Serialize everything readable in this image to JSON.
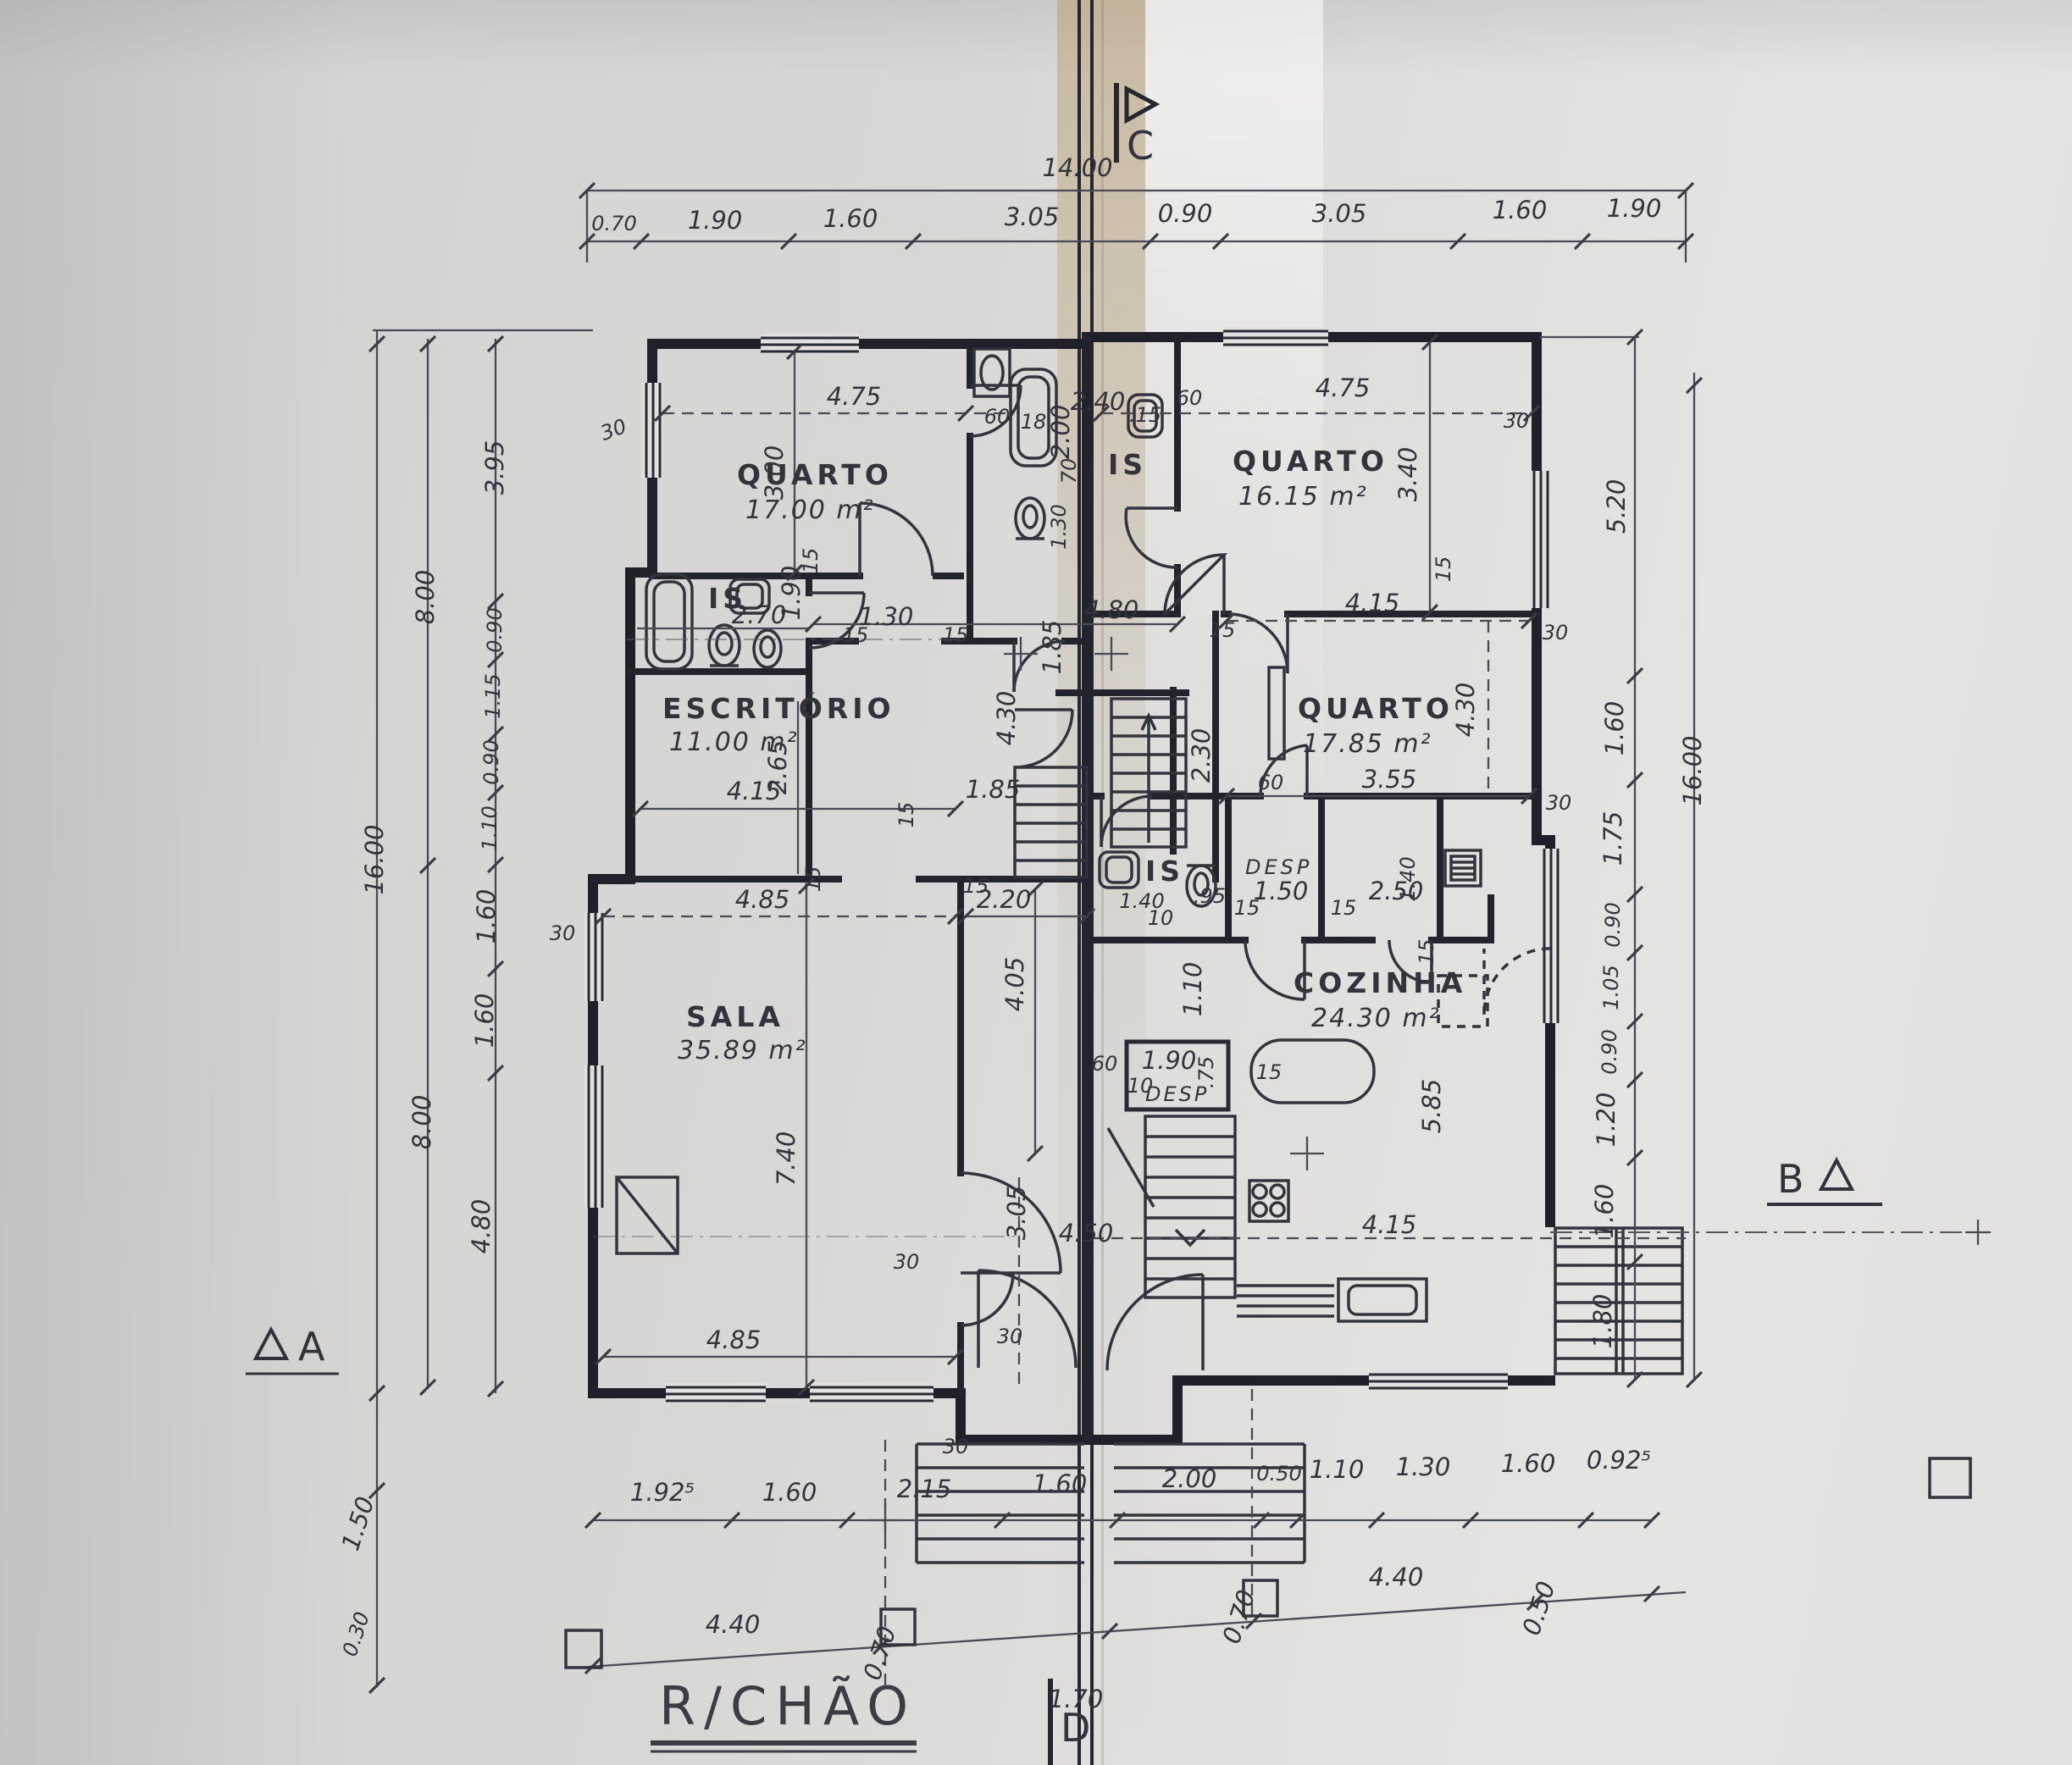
{
  "title": "R/CHÃO",
  "markers": {
    "c": "C",
    "d": "D",
    "a": "A",
    "b": "B"
  },
  "rooms": {
    "quarto1": {
      "name": "QUARTO",
      "area": "17.00 m²"
    },
    "quarto2": {
      "name": "QUARTO",
      "area": "16.15 m²"
    },
    "quarto3": {
      "name": "QUARTO",
      "area": "17.85 m²"
    },
    "escritorio": {
      "name": "ESCRITÓRIO",
      "area": "11.00 m²"
    },
    "sala": {
      "name": "SALA",
      "area": "35.89 m²"
    },
    "cozinha": {
      "name": "COZINHA",
      "area": "24.30 m²"
    },
    "is": "IS",
    "desp": "DESP"
  },
  "dims": {
    "overall_top": "14.00",
    "top": [
      "0.70",
      "1.90",
      "1.60",
      "3.05",
      "0.90",
      "3.05",
      "1.60",
      "1.90"
    ],
    "left": {
      "outer": "16.00",
      "mid_a": "8.00",
      "mid_b": "8.00",
      "chain": [
        "3.95",
        "0.90",
        "1.15",
        "0.90",
        "1.10",
        "1.60",
        "1.60",
        "4.80"
      ],
      "below": [
        "1.50",
        "0.30"
      ]
    },
    "right": {
      "outer": "16.00",
      "chain": [
        "5.20",
        "1.60",
        "1.75",
        "0.90",
        "1.05",
        "0.90",
        "1.20",
        "1.60",
        "1.80"
      ]
    },
    "bottom": [
      "1.92⁵",
      "1.60",
      "2.15",
      "1.60",
      "2.00",
      "0.50",
      "1.10",
      "1.30",
      "1.60",
      "0.92⁵"
    ],
    "ground": [
      "4.40",
      "0.70",
      "1.70",
      "0.70",
      "4.40",
      "0.50"
    ]
  },
  "labels": {
    "q1_w": "4.75",
    "q1_h": "3.00",
    "q2_w": "4.75",
    "q2_h": "3.40",
    "q3_w": "4.15",
    "q3_h": "4.30",
    "q3_b": "3.55",
    "esc_w": "4.15",
    "esc_h": "2.65",
    "sala_w": "4.85",
    "sala_w2": "4.85",
    "sala_h": "7.40",
    "hall_w": "4.80",
    "hall_d": "1.85",
    "hall_d2": "1.85",
    "hall_h": "4.30",
    "stair_w": "2.30",
    "pass": "2.20",
    "pass_h": "4.05",
    "entry_h": "3.05",
    "entry_w": "4.50",
    "is1_w": "2.70",
    "is1_h": "1.90",
    "is2_w": "2.40",
    "is2_tub": "18",
    "is2_h": "2.00",
    "is2_d": "1.30",
    "is2_s": "70",
    "is3_s": ".15",
    "is4_w": "1.40",
    "is4_t": ".95",
    "desp1_w": "1.50",
    "store_w": "2.50",
    "store_h": "1.40",
    "desp2_w": "1.90",
    "desp2_h": ".75",
    "coz_w": "4.15",
    "coz_h": "5.85",
    "coz_s": "1.10",
    "t30": "30",
    "t15": "15",
    "t60": "60",
    "t10": "10"
  }
}
